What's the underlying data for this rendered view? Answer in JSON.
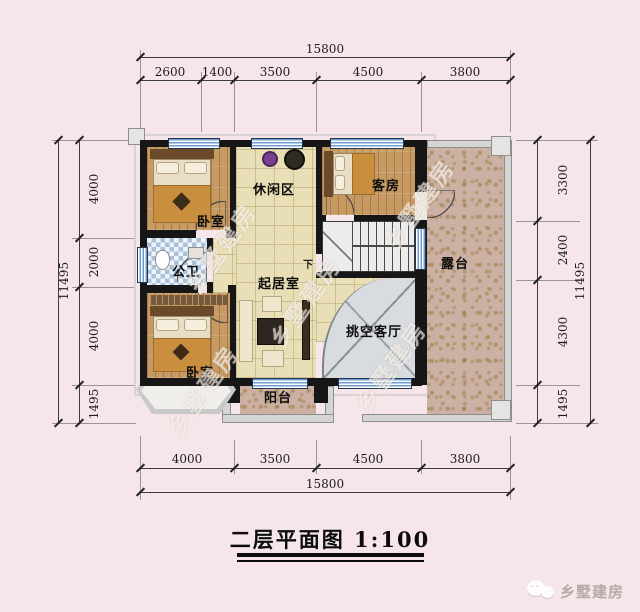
{
  "title": {
    "text": "二层平面图 1:100"
  },
  "watermark": {
    "text": "乡墅建房"
  },
  "brand": {
    "name": "乡墅建房"
  },
  "rooms": {
    "bedroom_top": "卧室",
    "leisure": "休闲区",
    "guest": "客房",
    "bath": "公卫",
    "living": "起居室",
    "void_hall": "挑空客厅",
    "bedroom_bottom": "卧室",
    "balcony": "阳台",
    "terrace": "露台",
    "stairs_down": "下"
  },
  "dimensions": {
    "top": {
      "total": "15800",
      "segments": [
        "2600",
        "1400",
        "3500",
        "4500",
        "3800"
      ]
    },
    "bottom": {
      "total": "15800",
      "segments": [
        "4000",
        "3500",
        "4500",
        "3800"
      ]
    },
    "left": {
      "total": "11495",
      "segments": [
        "4000",
        "2000",
        "4000",
        "1495"
      ]
    },
    "right": {
      "total": "11495",
      "segments": [
        "3300",
        "2400",
        "4300",
        "1495"
      ]
    }
  },
  "colors": {
    "background": "#f6e6ea",
    "wall": "#161616",
    "window_blue": "#6f9cd0",
    "wood_floor": "#c69a62",
    "tile_floor": "#e9dfb6",
    "terrace_floral": "#ccb0a3",
    "void_gray": "#d8dbdf"
  }
}
